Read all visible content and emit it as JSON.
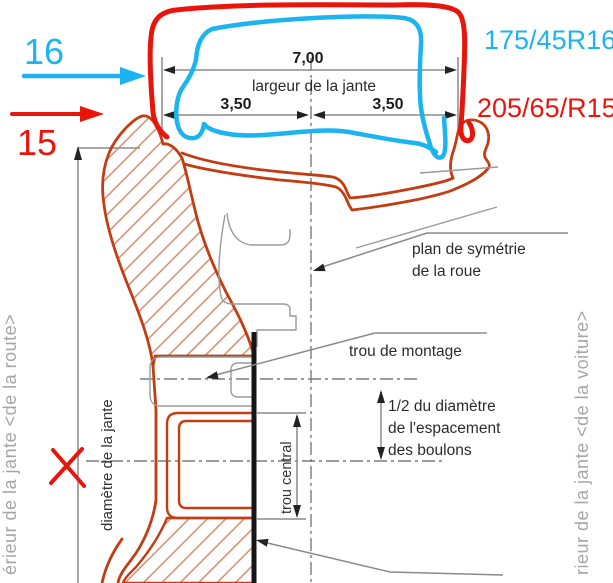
{
  "colors": {
    "annotation_cyan": "#1cb4f0",
    "annotation_red": "#e8150d",
    "drawing_outline": "#c23d12",
    "hatch": "#cf8365",
    "dimension_gray": "#8a8a8a",
    "side_text_gray": "#a6a6a6"
  },
  "hand_annotations": {
    "rim_size_16": "16",
    "rim_size_15": "15",
    "tire_code_16": "175/45R16",
    "tire_code_15": "205/65/R15"
  },
  "dimensions": {
    "rim_width": "7,00",
    "rim_width_label": "largeur de la jante",
    "half_width_left": "3,50",
    "half_width_right": "3,50",
    "rim_diameter_label": "diamètre de la jante",
    "center_hole_label": "trou central"
  },
  "callouts": {
    "symmetry_plane_line1": "plan de symétrie",
    "symmetry_plane_line2": "de la roue",
    "mounting_hole": "trou de montage",
    "bolt_circle_line1": "1/2 du diamètre",
    "bolt_circle_line2": "de l'espacement",
    "bolt_circle_line3": "des boulons"
  },
  "side_labels": {
    "left": "érieur de la jante <de la route>",
    "right": "rieur de la jante <de la voiture>"
  }
}
